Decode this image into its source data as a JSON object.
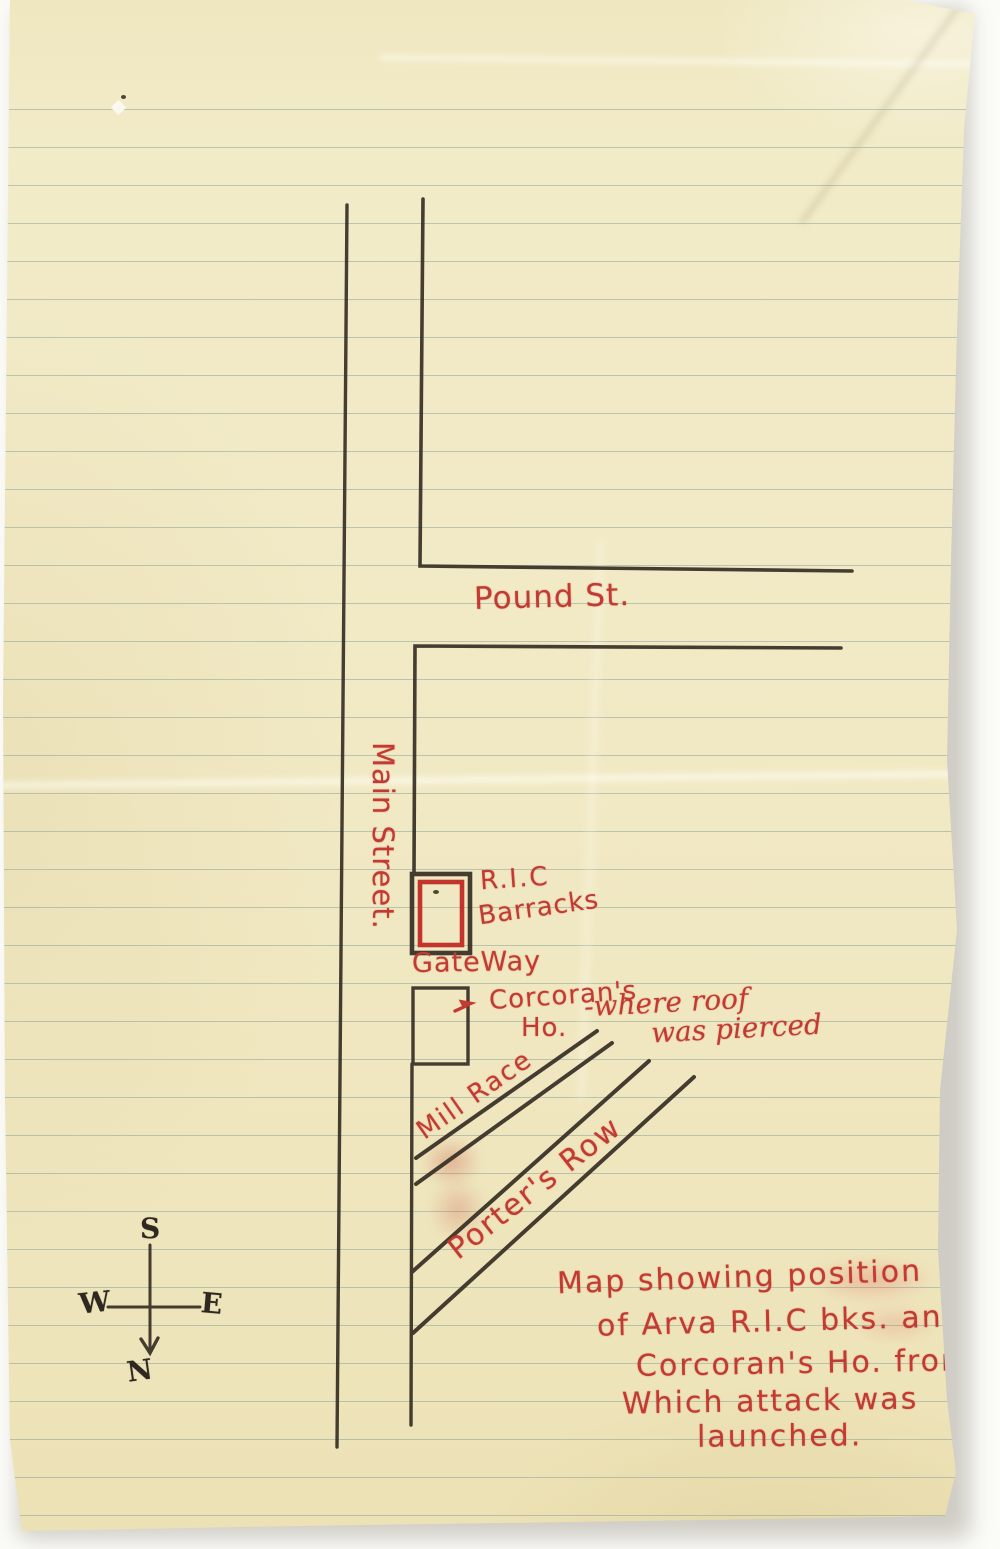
{
  "map": {
    "streets": {
      "pound_st": "Pound St.",
      "main_street": "Main Street.",
      "mill_race": "Mill Race",
      "porters_row": "Porter's Row"
    },
    "buildings": {
      "ric_label_line1": "R.I.C",
      "ric_label_line2": "Barracks",
      "gateway": "GateWay",
      "corcorans_line1": "Corcoran's",
      "corcorans_line2": "Ho.",
      "roof_note_line1": "-where roof",
      "roof_note_line2": "was pierced"
    },
    "compass": {
      "south": "S",
      "west": "W",
      "east": "E",
      "north": "N"
    },
    "caption": {
      "line1": "Map showing position",
      "line2": "of Arva R.I.C bks. and",
      "line3": "Corcoran's Ho. from",
      "line4": "Which attack was",
      "line5": "launched."
    },
    "colors": {
      "red_ink": "#c23a31",
      "dark_ink": "#2e2820",
      "paper": "#f1e9c4"
    }
  }
}
